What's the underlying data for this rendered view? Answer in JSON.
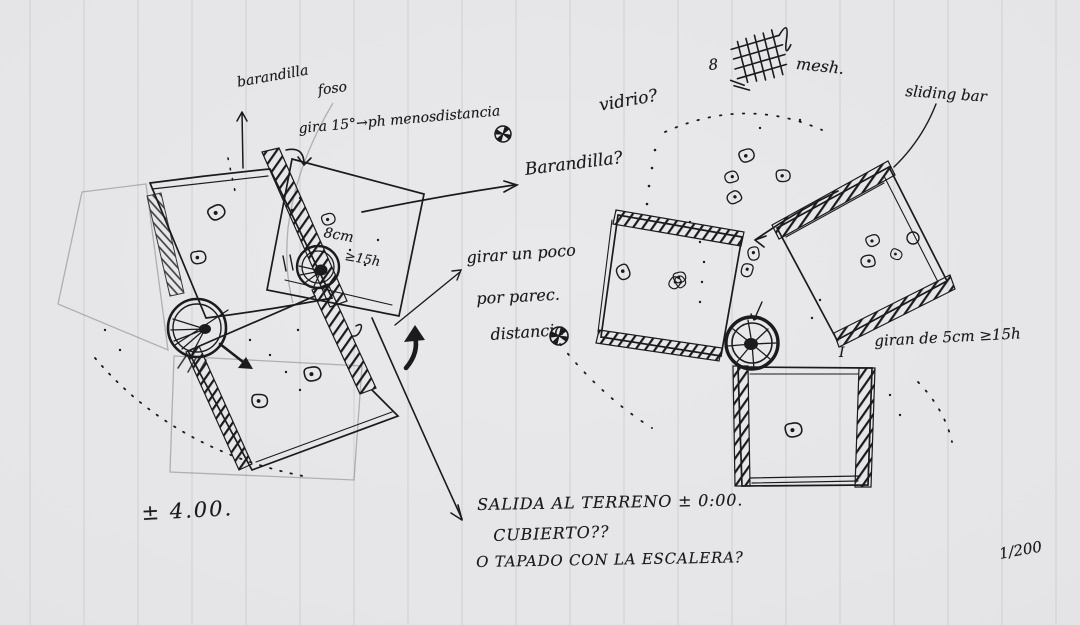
{
  "sketch": {
    "type": "hand-drawn architectural plan sketch on ruled paper",
    "colors": {
      "paper": "#e6e6e8",
      "ink": "#1b1b1d",
      "pencil": "#55555e",
      "ruled_line": "#c9c9ce"
    },
    "annotations": {
      "barandilla_top": "barandilla",
      "foso_label": "foso",
      "gira_note": "gira 15°→ph menosdistancia",
      "barandilla_question": "Barandilla?",
      "dim_8cm": "8cm",
      "dim_8cm_height": "≥15h",
      "girar_note_line1": "girar un poco",
      "girar_note_line2": "por parec.",
      "girar_note_line3": "distancia",
      "vidrio_question": "vidrio?",
      "mesh_count": "8",
      "mesh_label": "mesh.",
      "sliding_bar_label": "sliding bar",
      "gira_5cm_note": "giran de 5cm ≥15h",
      "i_mark": "I",
      "level_annotation": "± 4.00.",
      "salida_line1": "SALIDA AL TERRENO ± 0:00.",
      "salida_line2": "CUBIERTO??",
      "salida_line3": "O TAPADO CON LA ESCALERA?",
      "scale_fraction": "1/200"
    },
    "icons": [
      "pinwheel-icon",
      "mesh-grid-icon",
      "spiral-stair-icon",
      "up-arrow-icon"
    ]
  }
}
